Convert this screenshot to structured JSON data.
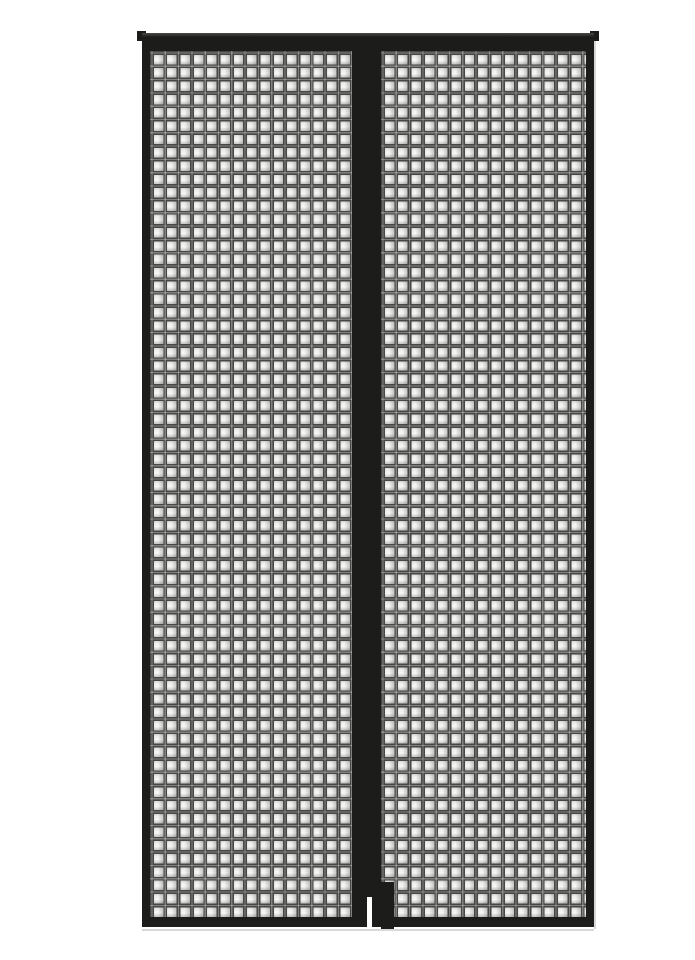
{
  "product_image": {
    "subject": "magnetic-mesh-screen-door-curtain",
    "panel_count": 2,
    "mesh_pattern": "square-grid",
    "closure": "center-magnetic-seam-with-bottom-gap"
  },
  "colors": {
    "background": "#ffffff",
    "frame_black": "#1c1c1a",
    "frame_highlight": "#4a4a48",
    "mesh_line": "#474745",
    "cell_top": "#a3a3a1",
    "cell_mid": "#eeeeec",
    "cell_bright": "#f7f7f5",
    "cell_bottom": "#c2c2c0",
    "edge_shadow": "#d8d8d6"
  }
}
